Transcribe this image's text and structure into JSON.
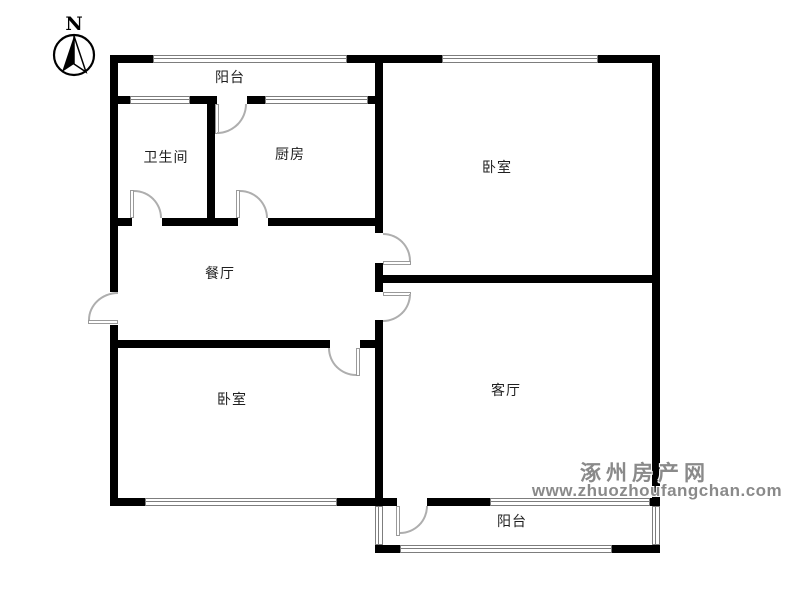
{
  "compass": {
    "north_label": "N"
  },
  "rooms": {
    "balcony_top": "阳台",
    "bathroom": "卫生间",
    "kitchen": "厨房",
    "bedroom_top": "卧室",
    "dining": "餐厅",
    "bedroom_bottom": "卧室",
    "living": "客厅",
    "balcony_bottom": "阳台"
  },
  "watermark": {
    "site_name": "涿州房产网",
    "site_url": "www.zhuozhoufangchan.com"
  }
}
